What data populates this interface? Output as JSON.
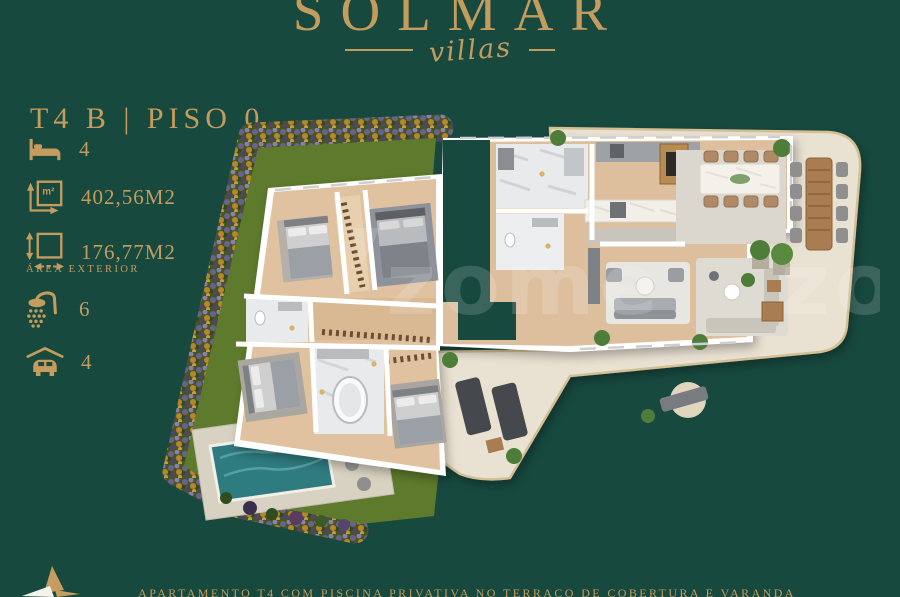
{
  "brand": {
    "name": "SOLMAR",
    "tagline": "villas",
    "logo_mark_icon": "four-point-star-icon"
  },
  "plan": {
    "title": "T4 B | PISO 0"
  },
  "stats": {
    "bedrooms": {
      "icon": "bed-icon",
      "value": "4"
    },
    "total_area": {
      "icon": "area-m2-icon",
      "value": "402,56M2"
    },
    "exterior_area": {
      "icon": "exterior-area-icon",
      "value": "176,77M2",
      "label": "ÁREA EXTERIOR"
    },
    "bathrooms": {
      "icon": "shower-icon",
      "value": "6"
    },
    "parking": {
      "icon": "car-garage-icon",
      "value": "4"
    }
  },
  "caption": "APARTAMENTO T4 COM PISCINA PRIVATIVA NO TERRAÇO DE COBERTURA E VARANDA",
  "watermark": "zome",
  "colors": {
    "background": "#17493f",
    "gold": "#c49c5e",
    "wall": "#ffffff",
    "wood": "#ddbf9e",
    "terrace": "#e9e1d2",
    "grass": "#5e7a2c",
    "pool": "#2e7b80"
  }
}
